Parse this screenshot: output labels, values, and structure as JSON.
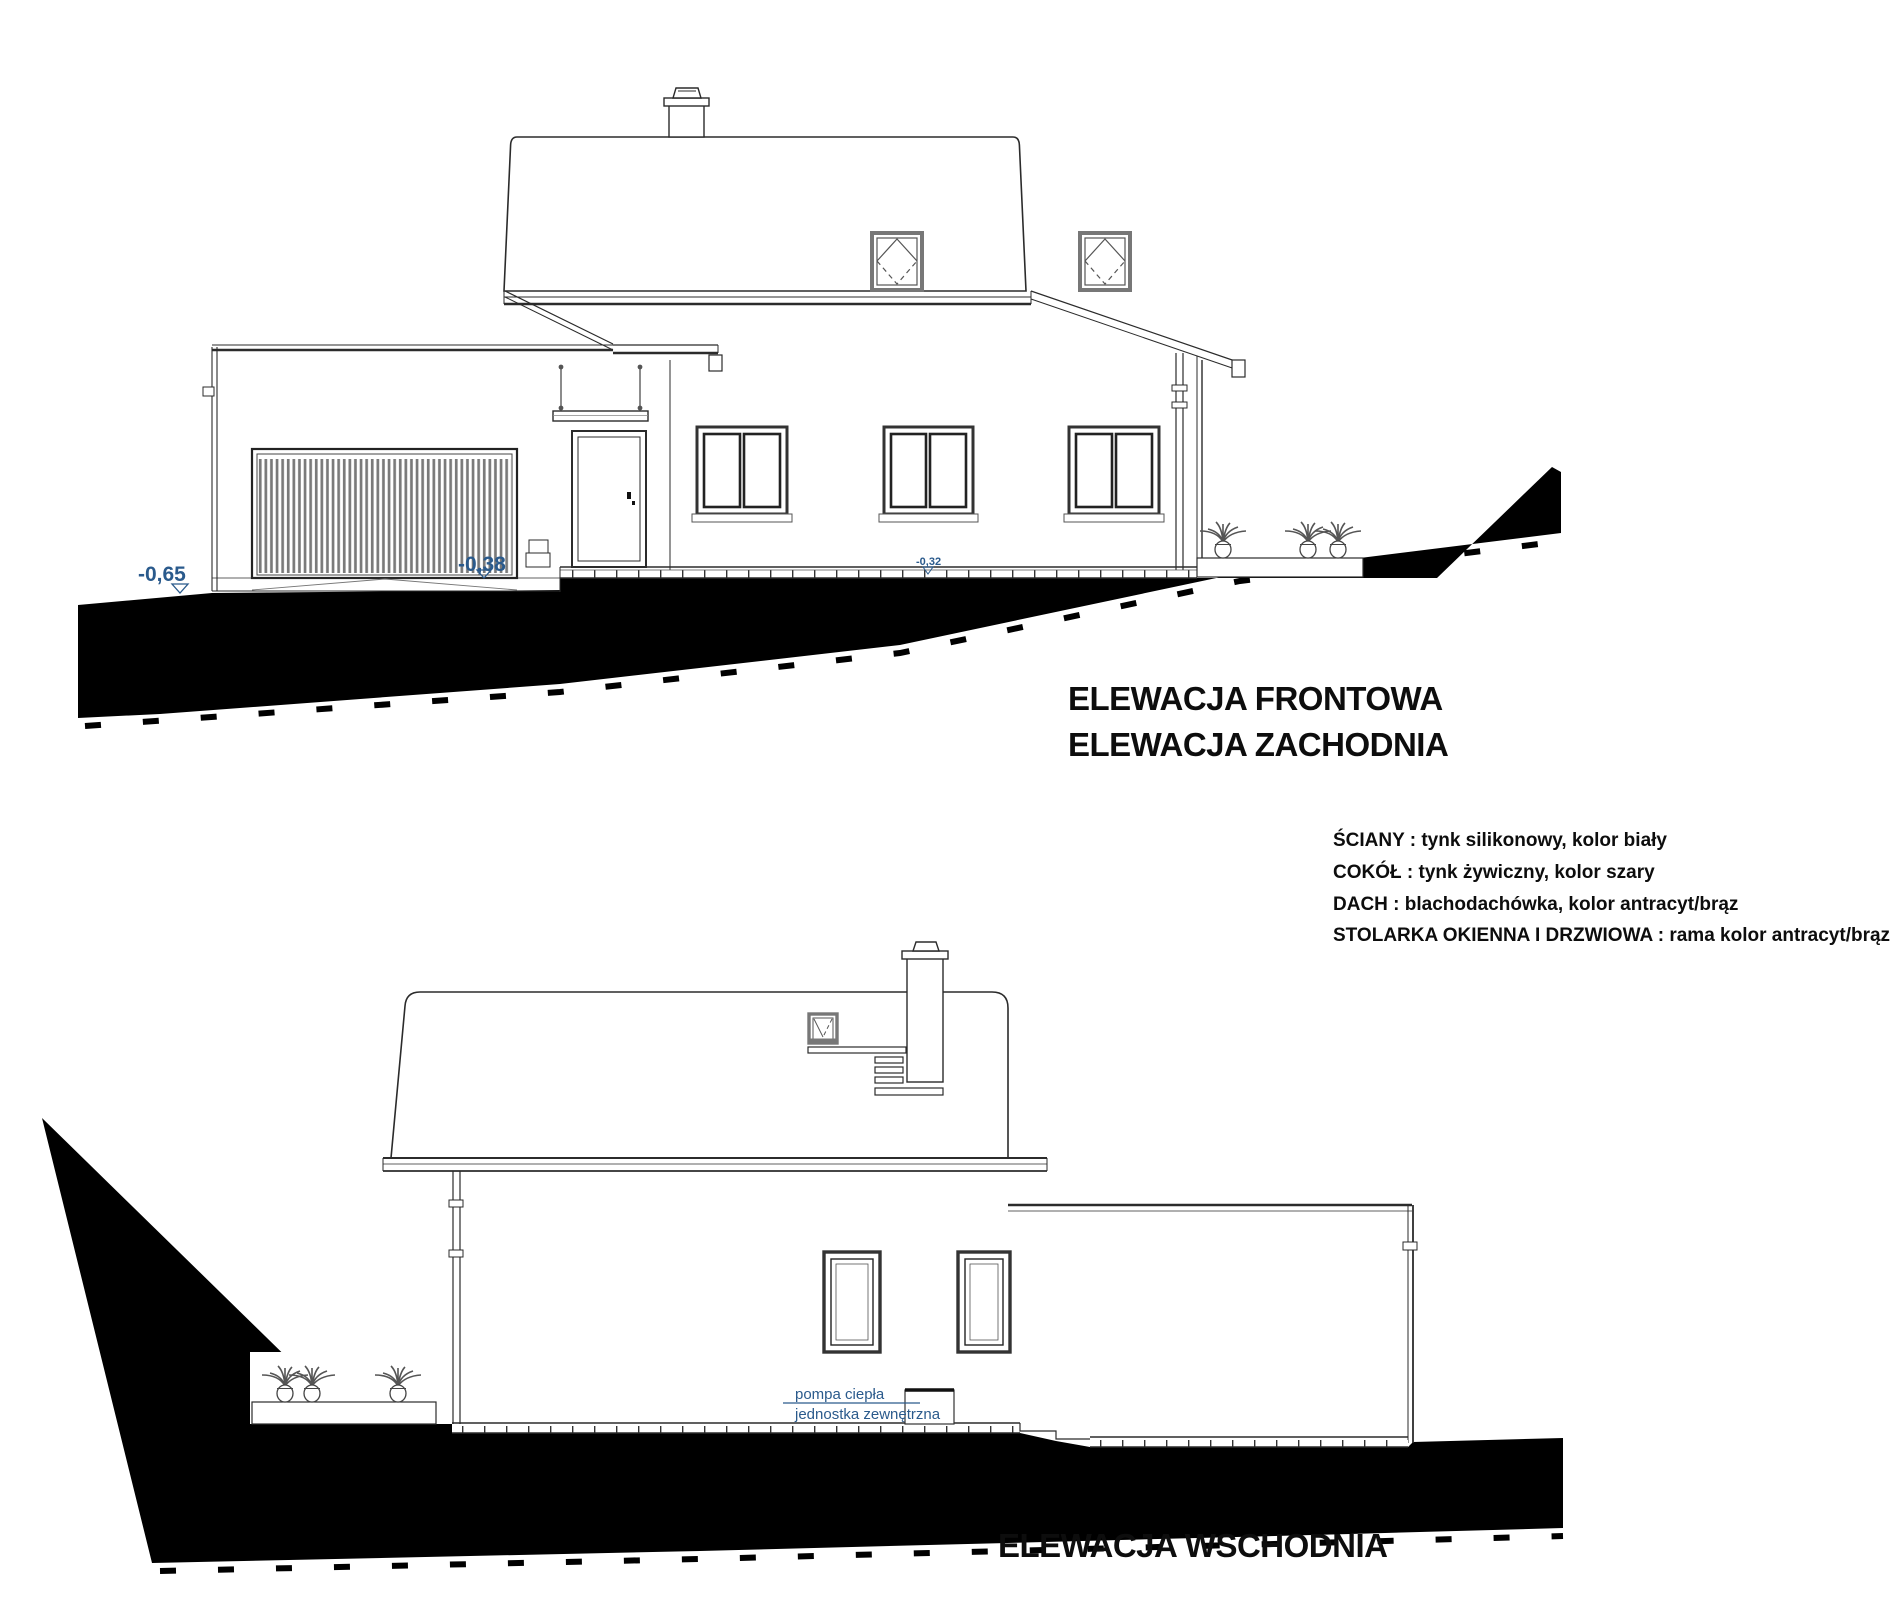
{
  "front_elevation": {
    "title_line1": "ELEWACJA FRONTOWA",
    "title_line2": "ELEWACJA ZACHODNIA",
    "levels": {
      "driveway": "-0,65",
      "garage_apron": "-0,38",
      "house_perimeter": "-0,32"
    }
  },
  "east_elevation": {
    "title": "ELEWACJA WSCHODNIA",
    "heat_pump_label_line1": "pompa ciepła",
    "heat_pump_label_line2": "jednostka zewnętrzna"
  },
  "materials_legend": {
    "walls": "ŚCIANY : tynk silikonowy, kolor biały",
    "plinth": "COKÓŁ : tynk żywiczny, kolor szary",
    "roof": "DACH : blachodachówka, kolor antracyt/brąz",
    "windows_doors": "STOLARKA OKIENNA I DRZWIOWA : rama kolor antracyt/brąz"
  },
  "colors": {
    "annotation_blue": "#2a5a8c",
    "line_dark": "#2b2b2b",
    "terrain_black": "#000000"
  }
}
